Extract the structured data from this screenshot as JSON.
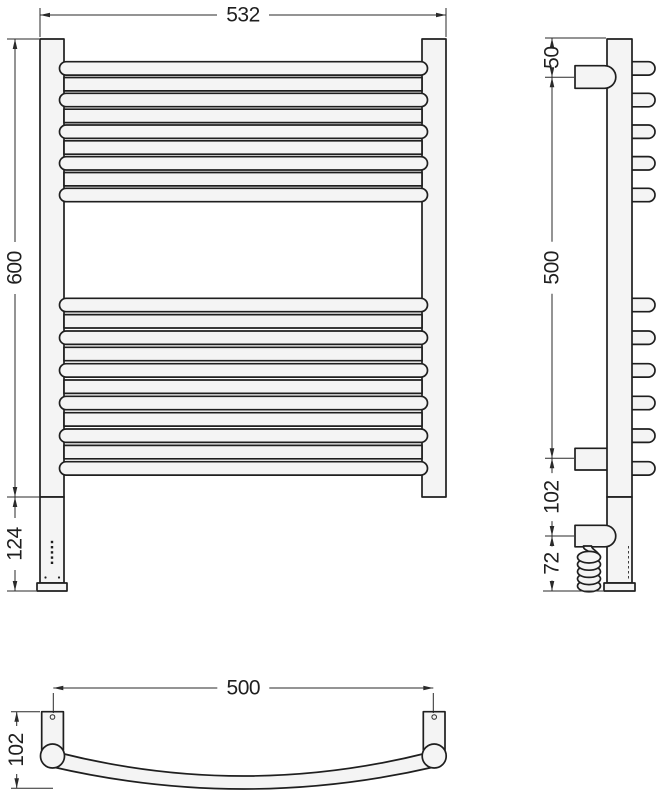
{
  "drawing": {
    "subject": "ladder towel rail - three orthographic views",
    "views": {
      "front": {
        "name": "front view",
        "crossbars_top_group": 9,
        "crossbars_bottom_group": 11,
        "curved_bars_top_group": 5,
        "curved_bars_bottom_group": 6
      },
      "side": {
        "name": "side view",
        "bar_stubs_top_group": 5,
        "bar_stubs_bottom_group": 6,
        "wall_brackets": 2
      },
      "plan": {
        "name": "bottom view",
        "mounting_plates": 2
      }
    },
    "colors": {
      "background": "#ffffff",
      "line": "#1f1f1f",
      "shape_fill": "#f4f4f4"
    }
  },
  "dimensions": {
    "front_width": "532",
    "front_height": "600",
    "front_heater": "124",
    "side_top": "50",
    "side_span": "500",
    "side_lower": "102",
    "side_cable": "72",
    "plan_span": "500",
    "plan_depth": "102"
  }
}
